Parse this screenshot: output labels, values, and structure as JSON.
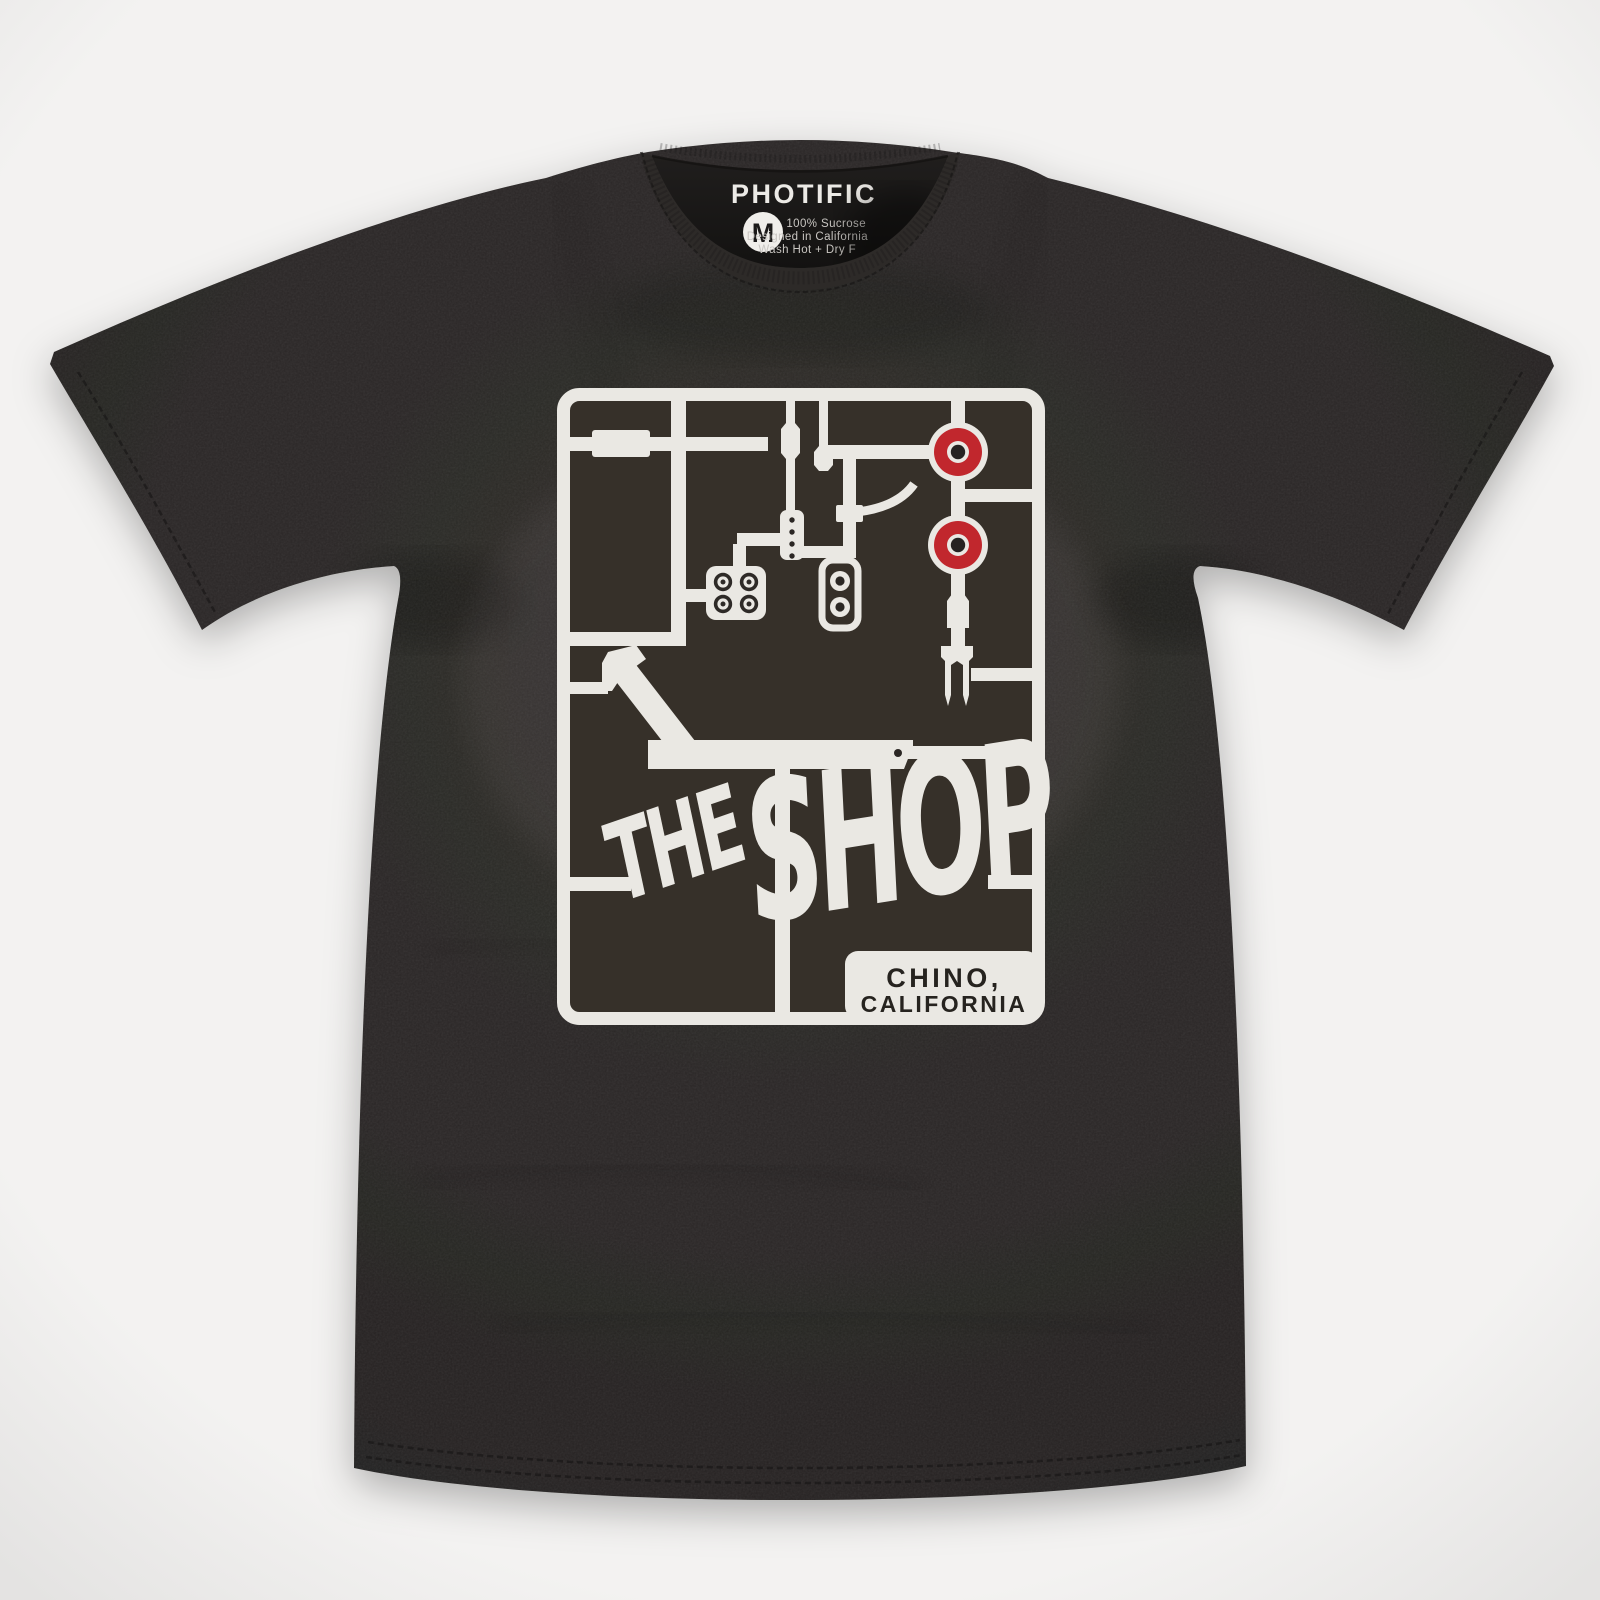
{
  "scene": {
    "description": "Flat-lay product photo of a black crew-neck t-shirt with a white model-kit sprue graphic of skateboard parts"
  },
  "neck_label": {
    "brand": "PHOTIFIC",
    "size": "M",
    "care_lines": [
      "100% Sucrose",
      "Designed in California",
      "Wash Hot + Dry F"
    ]
  },
  "graphic": {
    "word_the": "THE",
    "word_shop": "SHOP",
    "location_line1": "CHINO,",
    "location_line2": "CALIFORNIA",
    "parts": [
      "sprue-frame",
      "skateboard-wheel-top",
      "skateboard-wheel-bottom",
      "hardware-bolt-plate",
      "truck-bushing-part",
      "kingpin-fork-part",
      "deck-rail-part",
      "axle-pin-a",
      "axle-pin-b",
      "bearing-rail-part"
    ]
  },
  "colors": {
    "page-bg": "#f3f2f1",
    "page-edge": "#e4e3e2",
    "shirt": "#292625",
    "shirt-hi": "#302d2b",
    "shirt-dark": "#191716",
    "collar": "#2d2a28",
    "graphic-bg": "#363029",
    "print": "#eae8e3",
    "wheel-red": "#c1272d",
    "label-text": "#eceae6",
    "care-text": "#c9c6c2",
    "box-text": "#26231f"
  }
}
